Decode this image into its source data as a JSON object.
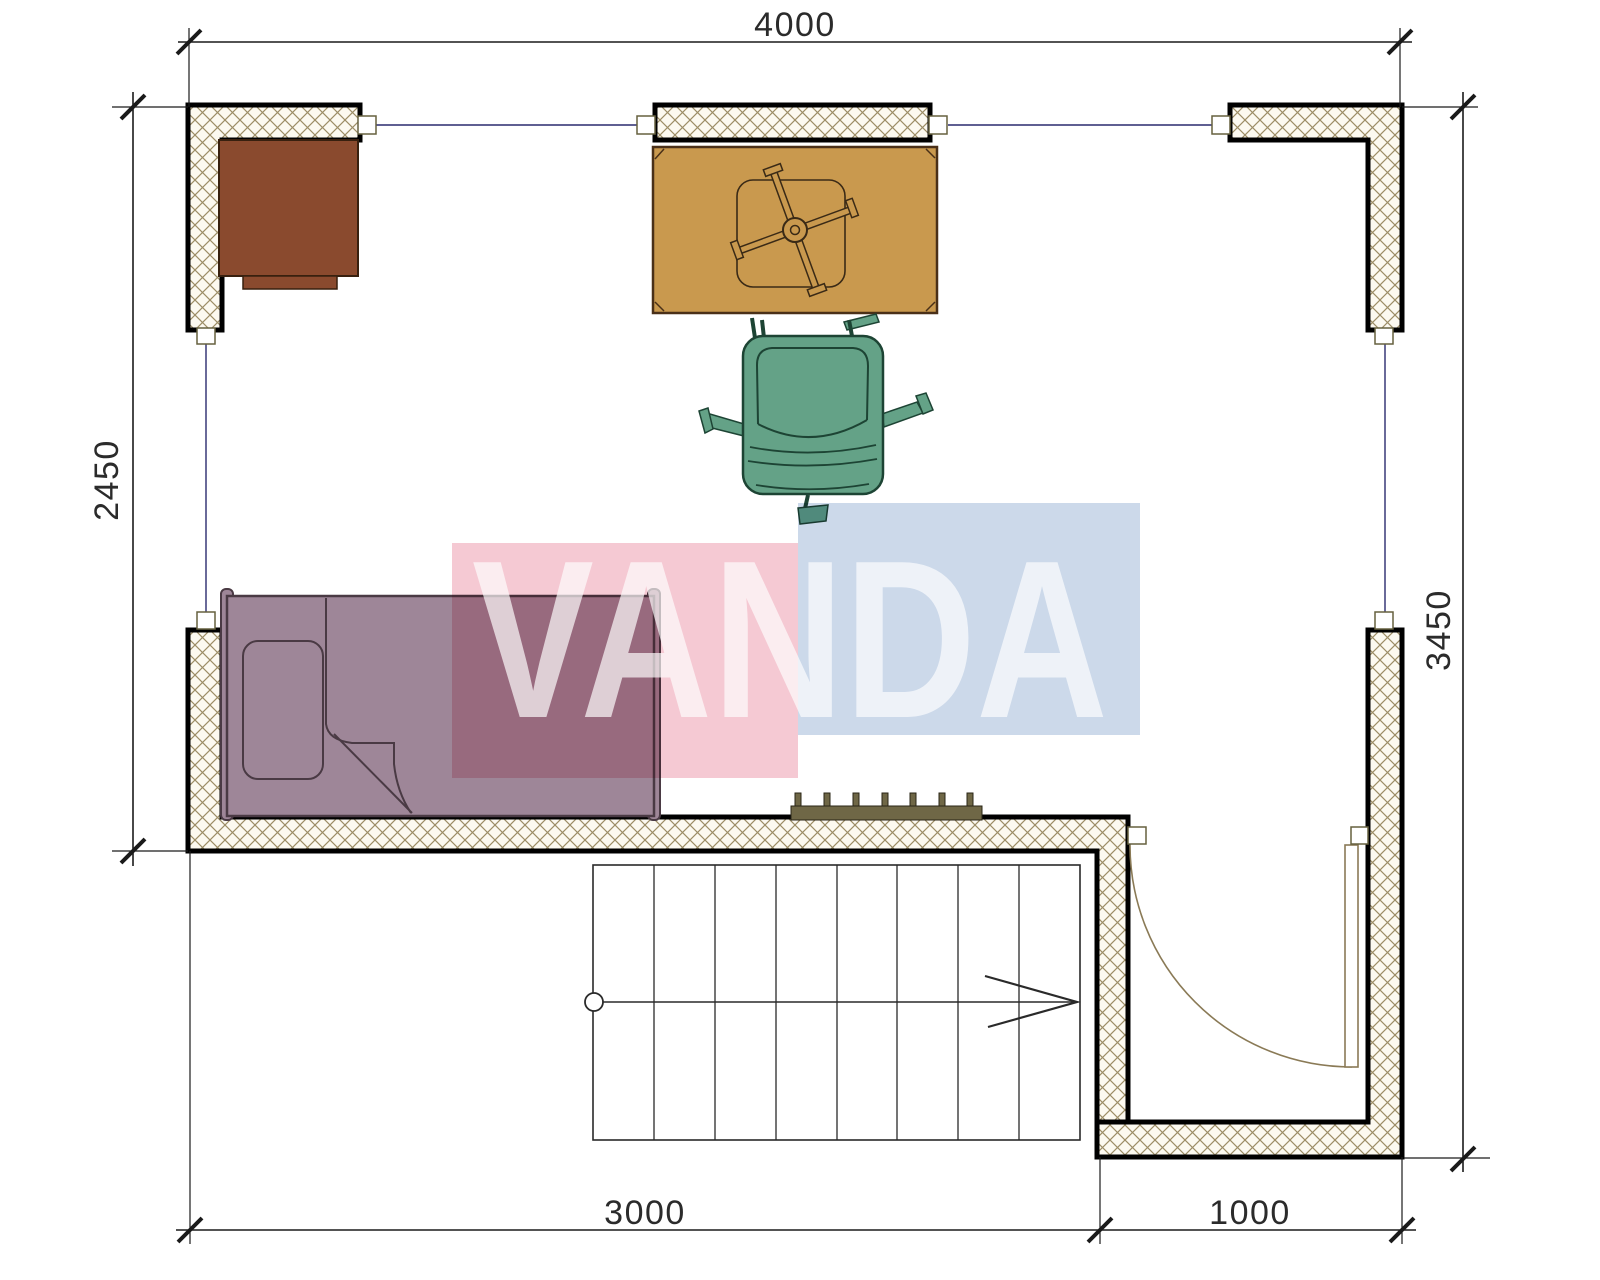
{
  "drawing": {
    "type": "architectural floor plan",
    "dimensions_mm": {
      "top": "4000",
      "left": "2450",
      "right": "3450",
      "bottom_left": "3000",
      "bottom_right": "1000"
    },
    "watermark": {
      "text": "VANDA",
      "pink_color": "#f5c9d3",
      "blue_color": "#ccd9ea"
    },
    "colors": {
      "wall_fill": "#fcf9f0",
      "wall_hatch_line": "#9c8d66",
      "wall_border": "#000000",
      "axis_line": "#2a2a6e",
      "dimension_line": "#1a1a1a",
      "desk": "#8a4a2e",
      "table": "#c9994e",
      "chair": "#64a287",
      "bed": "#9e8698",
      "radiator": "#6f6746",
      "door_arc": "#8a7a56"
    },
    "furniture": [
      "desk",
      "table-with-fan",
      "office-chair",
      "single-bed",
      "pillow",
      "radiator",
      "staircase",
      "swing-door"
    ]
  }
}
